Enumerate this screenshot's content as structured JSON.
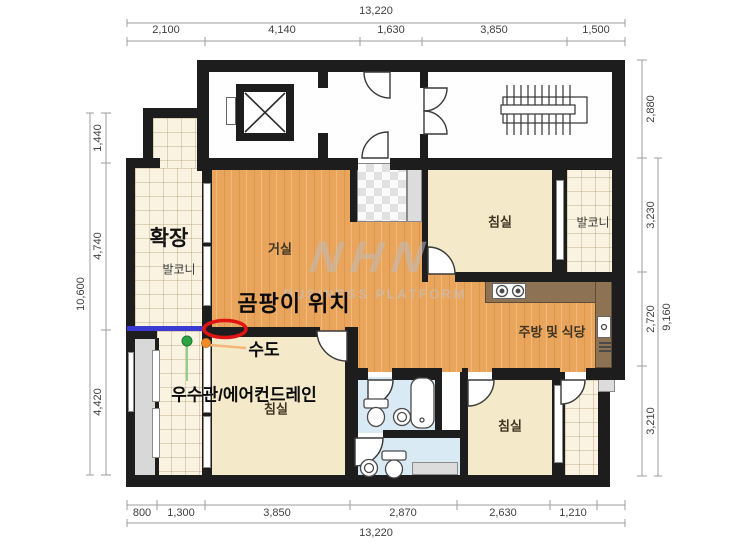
{
  "floor_plan": {
    "dimensions": {
      "top": {
        "total": "13,220",
        "segments": [
          "2,100",
          "4,140",
          "1,630",
          "3,850",
          "1,500"
        ]
      },
      "bottom": {
        "total": "13,220",
        "segments": [
          "800",
          "1,300",
          "3,850",
          "2,870",
          "2,630",
          "1,210"
        ]
      },
      "left": {
        "total": "10,600",
        "segments": [
          "1,440",
          "4,740",
          "4,420"
        ]
      },
      "right": {
        "total": "9,160",
        "segments": [
          "2,880",
          "3,230",
          "2,720",
          "3,210"
        ]
      }
    },
    "rooms": {
      "expansion": "확장",
      "balcony_left": "발코니",
      "living_room": "거실",
      "bedroom_top_right": "침실",
      "balcony_right": "발코니",
      "kitchen_dining": "주방 및 식당",
      "bedroom_bottom_left": "침실",
      "bedroom_bottom_right": "침실"
    },
    "annotations": {
      "mold_location": "곰팡이 위치",
      "water_supply": "수도",
      "rain_pipe_ac_drain": "우수관/에어컨드레인"
    },
    "marker_colors": {
      "mold_circle": "#e11414",
      "pipe_line": "#3b3bd4",
      "water_dot": "#f08c28",
      "drain_dot": "#2ca344"
    },
    "watermark": {
      "logo": "NHN",
      "subtitle": "BUSINESS PLATFORM"
    }
  }
}
